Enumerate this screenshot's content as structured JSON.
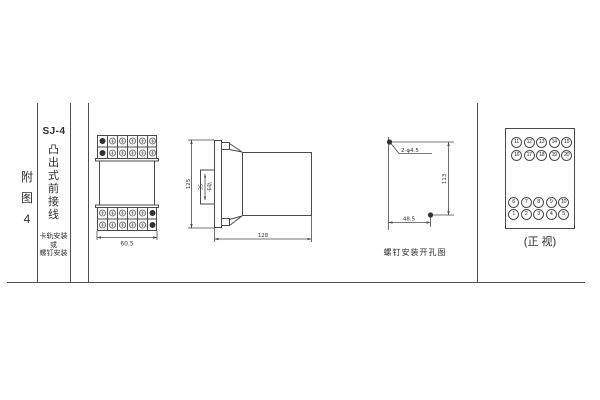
{
  "page": {
    "background": "#ffffff",
    "line_color": "#4a4a4a",
    "text_color": "#2e2e2e"
  },
  "margin": {
    "figure_label": "附图4"
  },
  "title_block": {
    "model": "SJ-4",
    "style_name": "凸出式前接线",
    "mounting_lines": [
      "卡轨安装",
      "或",
      "螺钉安装"
    ]
  },
  "front_view": {
    "width_dim": "60.5"
  },
  "side_view": {
    "height_dim": "125",
    "rail_height_dim": "35",
    "rail_label": "卡轨",
    "depth_dim": "128"
  },
  "drill_view": {
    "hole_label": "2-φ4.5",
    "vertical_dim": "113",
    "horizontal_dim": "48.5",
    "caption": "螺钉安装开孔图"
  },
  "terminal_view": {
    "caption": "(正 视)",
    "rows": [
      [
        "11",
        "12",
        "13",
        "14",
        "15"
      ],
      [
        "16",
        "17",
        "18",
        "19",
        "20"
      ],
      [
        "6",
        "7",
        "8",
        "9",
        "10"
      ],
      [
        "1",
        "2",
        "3",
        "4",
        "5"
      ]
    ]
  }
}
